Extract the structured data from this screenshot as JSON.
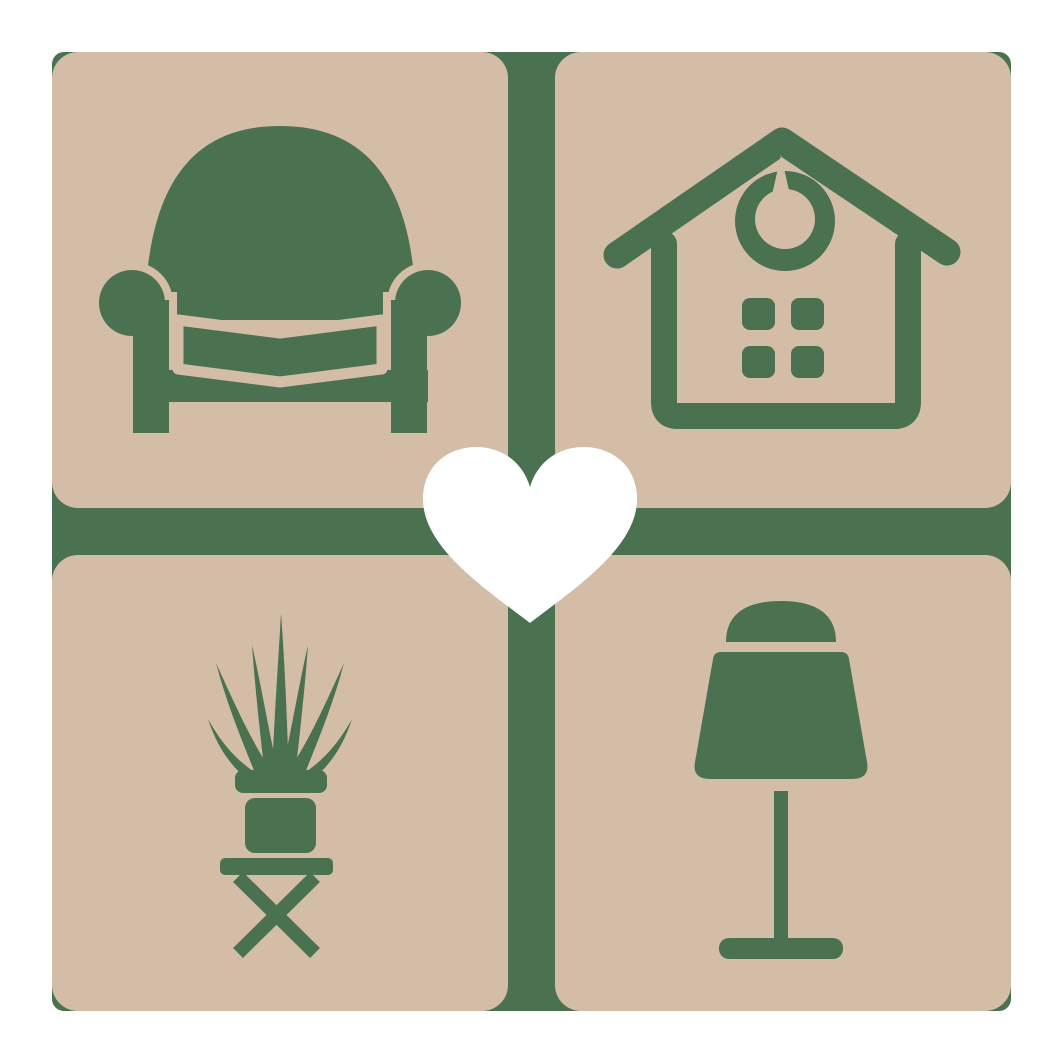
{
  "logo": {
    "description": "Home decor brand mark: four rounded tiles with furniture silhouettes arranged around a central heart over a green cross",
    "tiles": [
      {
        "id": "armchair",
        "position": "top-left",
        "icon": "armchair-icon"
      },
      {
        "id": "house",
        "position": "top-right",
        "icon": "house-icon"
      },
      {
        "id": "potted-plant",
        "position": "bottom-left",
        "icon": "potted-plant-icon"
      },
      {
        "id": "table-lamp",
        "position": "bottom-right",
        "icon": "table-lamp-icon"
      }
    ],
    "center": {
      "id": "heart",
      "icon": "heart-icon"
    }
  },
  "colors": {
    "tile": "#d4bda7",
    "icon": "#4a7150",
    "backing": "#4a7150",
    "heart": "#ffffff",
    "bg": "#ffffff"
  }
}
